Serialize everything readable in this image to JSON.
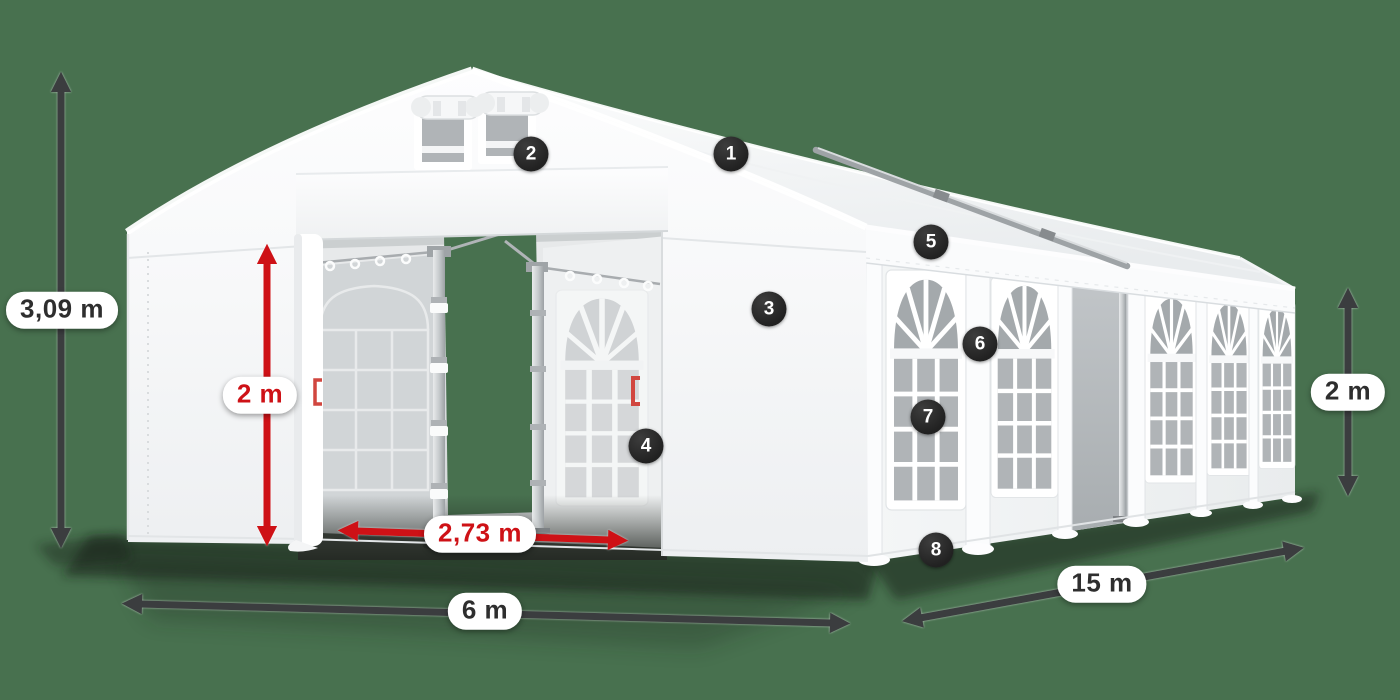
{
  "colors": {
    "background_green": "#48714F",
    "tent_white": "#FFFFFF",
    "accent_red": "#CE1116",
    "arrow_dark": "#3B3D3F",
    "marker_background": "#2A2A2A",
    "dimension_text": "#2E2E2E",
    "pill_background": "#FFFFFF"
  },
  "dimension_labels": {
    "total_height": "3,09 m",
    "entrance_height": "2 m",
    "entrance_width": "2,73 m",
    "tent_width": "6 m",
    "tent_length": "15 m",
    "side_wall_height": "2 m"
  },
  "callout_markers": {
    "m1": "1",
    "m2": "2",
    "m3": "3",
    "m4": "4",
    "m5": "5",
    "m6": "6",
    "m7": "7",
    "m8": "8"
  }
}
